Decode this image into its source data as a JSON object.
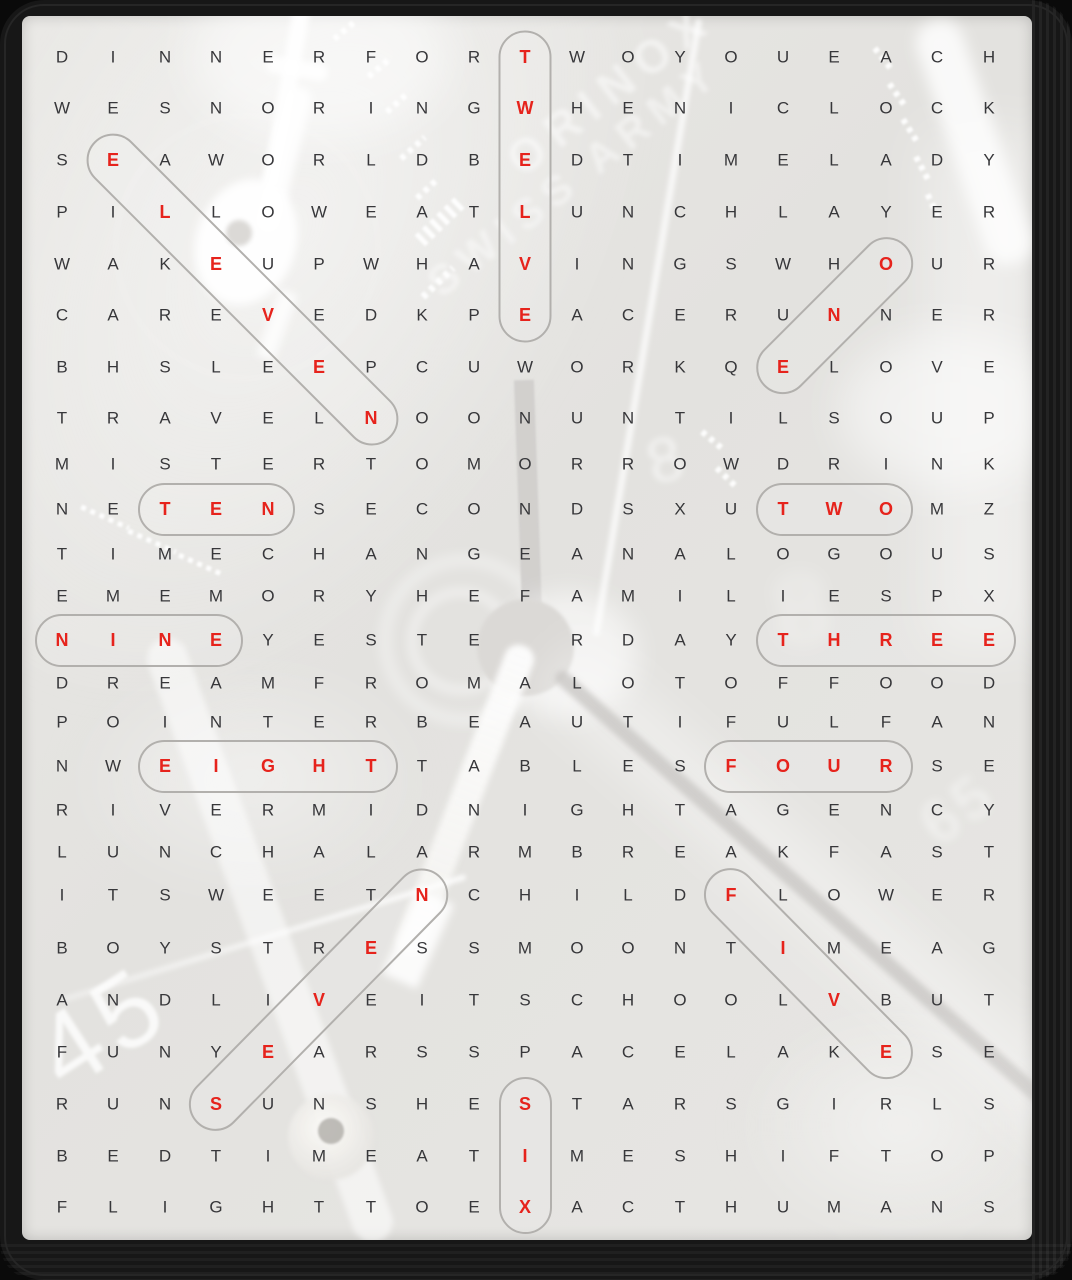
{
  "puzzle": {
    "type": "word-search",
    "theme": "clock times"
  },
  "grid_size": {
    "rows": 25,
    "cols": 19
  },
  "grid": {
    "rows": [
      "DINNERFORTWOYOUEACH",
      "WESNORINGWHENICLOCK",
      "SEAWORLDBEDTIMELADY",
      "PILLOWEATLUNCHLAYER",
      "WAKEUPWHAVINGSWHOUR",
      "CAREVEDKPEACERUNNER",
      "BHSLEEPCUWORKQELOVE",
      "TRAVELNOONUNTILSOUP",
      "MISTERTOMORROWDRINK",
      "NETENSECONDSXUTWOMZ",
      "TIMECHANGEANALOGOUS",
      "EMEMORYHEFAMILIESPX",
      "NINEYESTE RDAYTHREE",
      "DREAMFROMALOTOFFOOD",
      "POINTERBEAUTIFULFAN",
      "NWEIGHTTABLESFOURSE",
      "RIVERMIDNIGHTAGENCY",
      "LUNCHALARMBREAKFAST",
      "ITSWEETNCHILDFLOWER",
      "BOYSTRESSMOONTIMEAG",
      "ANDLIVEITSCHOOLVBUT",
      "FUNYEARSSPACELAKESE",
      "RUNSUNSHESTARSGIRLS",
      "BEDTIMEATIMESHIFTOP",
      "FLIGHTTOEXACTHUMANS"
    ]
  },
  "found_words": [
    {
      "word": "ONE",
      "start": [
        5,
        17
      ],
      "end": [
        7,
        15
      ]
    },
    {
      "word": "TWO",
      "start": [
        10,
        15
      ],
      "end": [
        10,
        17
      ]
    },
    {
      "word": "THREE",
      "start": [
        13,
        15
      ],
      "end": [
        13,
        19
      ]
    },
    {
      "word": "FOUR",
      "start": [
        16,
        14
      ],
      "end": [
        16,
        17
      ]
    },
    {
      "word": "FIVE",
      "start": [
        19,
        14
      ],
      "end": [
        22,
        17
      ]
    },
    {
      "word": "SIX",
      "start": [
        23,
        10
      ],
      "end": [
        25,
        10
      ]
    },
    {
      "word": "SEVEN",
      "start": [
        23,
        4
      ],
      "end": [
        19,
        8
      ]
    },
    {
      "word": "EIGHT",
      "start": [
        16,
        3
      ],
      "end": [
        16,
        7
      ]
    },
    {
      "word": "NINE",
      "start": [
        13,
        1
      ],
      "end": [
        13,
        4
      ]
    },
    {
      "word": "TEN",
      "start": [
        10,
        3
      ],
      "end": [
        10,
        5
      ]
    },
    {
      "word": "ELEVEN",
      "start": [
        3,
        2
      ],
      "end": [
        8,
        7
      ]
    },
    {
      "word": "TWELVE",
      "start": [
        1,
        10
      ],
      "end": [
        6,
        10
      ]
    }
  ],
  "colors": {
    "letter": "#37373a",
    "highlight": "#e6231c",
    "box_outline": "#b2b0ad",
    "paper": "#e5e4e1",
    "frame": "#171717"
  },
  "background": {
    "numerals": [
      "45",
      "65",
      "8"
    ],
    "brand_text": [
      "ORINOX",
      "SWISS ARMY"
    ]
  }
}
